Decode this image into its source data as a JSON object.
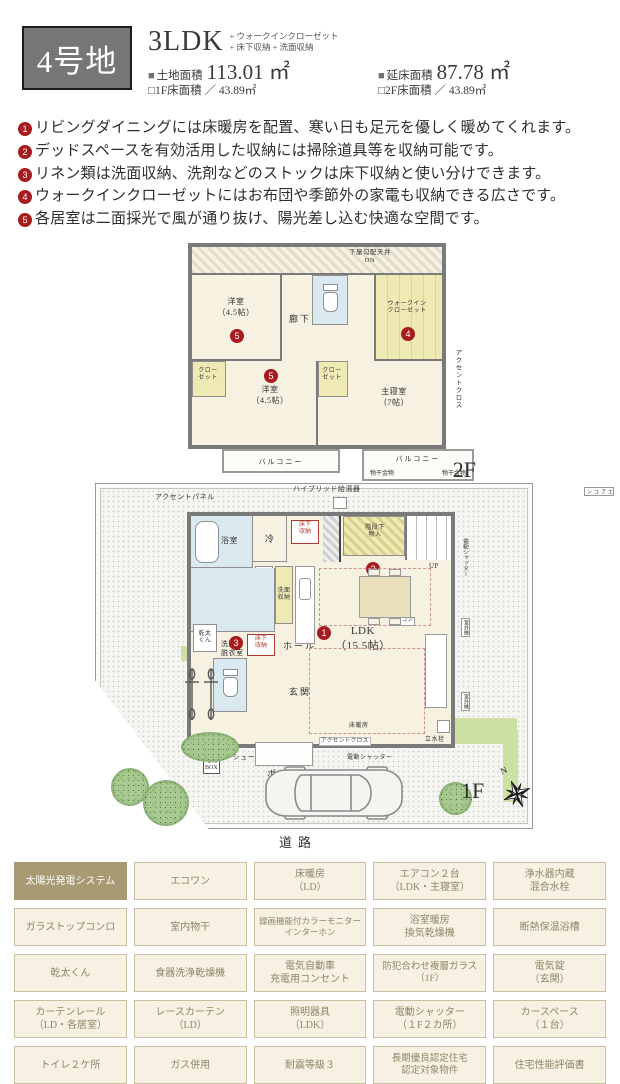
{
  "header": {
    "lot": "4号地",
    "type": "3LDK",
    "extras": "+ ウォークインクローゼット\n+ 床下収納 + 洗面収納",
    "land_marker": "■",
    "land_label": "土地面積",
    "land_value": "113.01 ㎡",
    "total_marker": "■",
    "total_label": "延床面積",
    "total_value": "87.78 ㎡",
    "f1_line": "□1F床面積 ／ 43.89㎡",
    "f2_line": "□2F床面積 ／ 43.89㎡"
  },
  "features": [
    {
      "num": "1",
      "text": "リビングダイニングには床暖房を配置、寒い日も足元を優しく暖めてくれます。"
    },
    {
      "num": "2",
      "text": "デッドスペースを有効活用した収納には掃除道具等を収納可能です。"
    },
    {
      "num": "3",
      "text": "リネン類は洗面収納、洗剤などのストックは床下収納と使い分けできます。"
    },
    {
      "num": "4",
      "text": "ウォークインクローゼットにはお布団や季節外の家電も収納できる広さです。"
    },
    {
      "num": "5",
      "text": "各居室は二面採光で風が通り抜け、陽光差し込む快適な空間です。"
    }
  ],
  "markers": {
    "m1": "1",
    "m2": "2",
    "m3": "3",
    "m4": "4",
    "m5": "5"
  },
  "plan2f": {
    "floor_label": "2F",
    "roof": "下屋勾配天井\nDN",
    "room1": "洋室\n（4.5帖）",
    "corridor": "廊下",
    "wic": "ウォークイン\nクローゼット",
    "closet": "クロー\nゼット",
    "room2": "洋室\n（4.5帖）",
    "master": "主寝室\n（7帖）",
    "balcony": "バルコニー",
    "hanger": "物干金物",
    "accent_cloth": "アクセントクロス",
    "aircon": "エアコン"
  },
  "plan1f": {
    "floor_label": "1F",
    "accent_panel": "アクセントパネル",
    "water_heater": "ハイブリッド給湯器",
    "bath": "浴室",
    "fridge": "冷",
    "underfloor": "床下\n収納",
    "stair_storage": "階段下\n物入",
    "up": "UP",
    "ps": "PS",
    "wash_storage": "洗面\n収納",
    "dryer": "乾太\nくん",
    "washroom": "洗面・\n脱衣室",
    "hall": "ホール",
    "genkan": "玄関",
    "shoes": "シューズボックス",
    "porch": "ポーチ",
    "delivery": "宅配\nBOX",
    "ldk": "LDK\n（15.5帖）",
    "floor_heating": "床暖房",
    "aircon": "エアコン",
    "accent_cloth": "アクセントクロス",
    "shutter": "電動シャッター",
    "outdoor_unit": "室外機",
    "faucet": "立水栓",
    "road": "道路",
    "north": "N"
  },
  "table": {
    "rows": [
      [
        "太陽光発電システム",
        "エコワン",
        "床暖房\n（LD）",
        "エアコン２台\n（LDK・主寝室）",
        "浄水器内蔵\n混合水栓"
      ],
      [
        "ガラストップコンロ",
        "室内物干",
        "録画機能付カラーモニター\nインターホン",
        "浴室暖房\n換気乾燥機",
        "断熱保温浴槽"
      ],
      [
        "乾太くん",
        "食器洗浄乾燥機",
        "電気自動車\n充電用コンセント",
        "防犯合わせ複層ガラス\n（1F）",
        "電気錠\n（玄関）"
      ],
      [
        "カーテンレール\n（LD・各居室）",
        "レースカーテン\n（LD）",
        "照明器具\n（LDK）",
        "電動シャッター\n（１F２カ所）",
        "カースペース\n（１台）"
      ],
      [
        "トイレ２ケ所",
        "ガス併用",
        "耐震等級３",
        "長期優良認定住宅\n認定対象物件",
        "住宅性能評価書"
      ]
    ]
  }
}
